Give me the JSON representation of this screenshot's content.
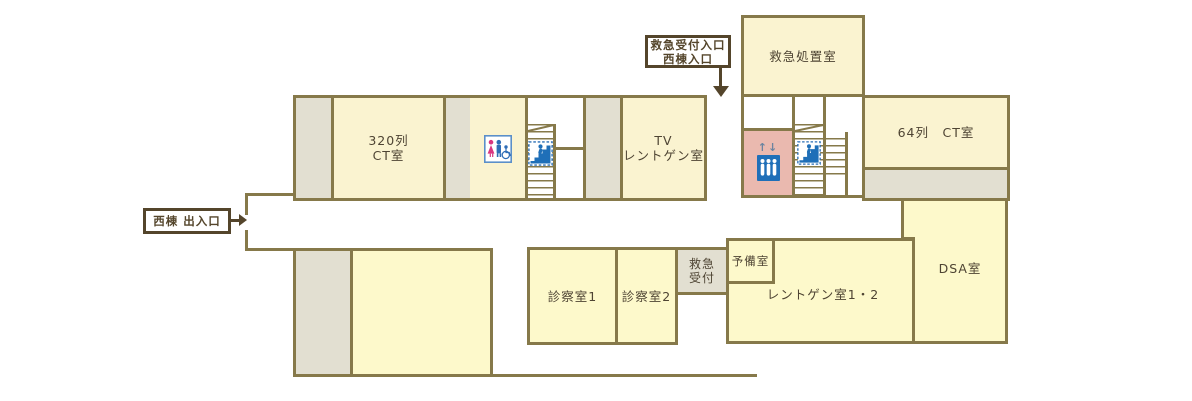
{
  "title": "hospital-floor-map",
  "rooms": {
    "ct320": {
      "line1": "320列",
      "line2": "CT室"
    },
    "tv_xray": {
      "line1": "TV",
      "line2": "レントゲン室"
    },
    "emergency_treatment": {
      "label": "救急処置室"
    },
    "ct64": {
      "label": "64列　CT室"
    },
    "dsa": {
      "label": "DSA室"
    },
    "exam1": {
      "label": "診察室1"
    },
    "exam2": {
      "label": "診察室2"
    },
    "emergency_reception": {
      "line1": "救急",
      "line2": "受付"
    },
    "reserve": {
      "label": "予備室"
    },
    "xray12": {
      "label": "レントゲン室1・2"
    }
  },
  "entrances": {
    "emergency_entrance": {
      "line1": "救急受付入口",
      "line2": "西棟入口"
    },
    "west_wing_exit": {
      "label": "西棟 出入口"
    }
  },
  "icons": {
    "elevator_arrows": "↑↓",
    "elevator": "elevator-icon",
    "stairs": "stairs-icon",
    "toilet": "toilet-icon"
  },
  "colors": {
    "wall": "#86794a",
    "entry_border": "#54452b",
    "room_cream": "#faf3d0",
    "room_yellow": "#fdf9cb",
    "service_grey": "#e2dfd1",
    "elevator_pink": "#eab9af",
    "icon_blue": "#1f6fb8",
    "female_pink": "#d93680"
  }
}
